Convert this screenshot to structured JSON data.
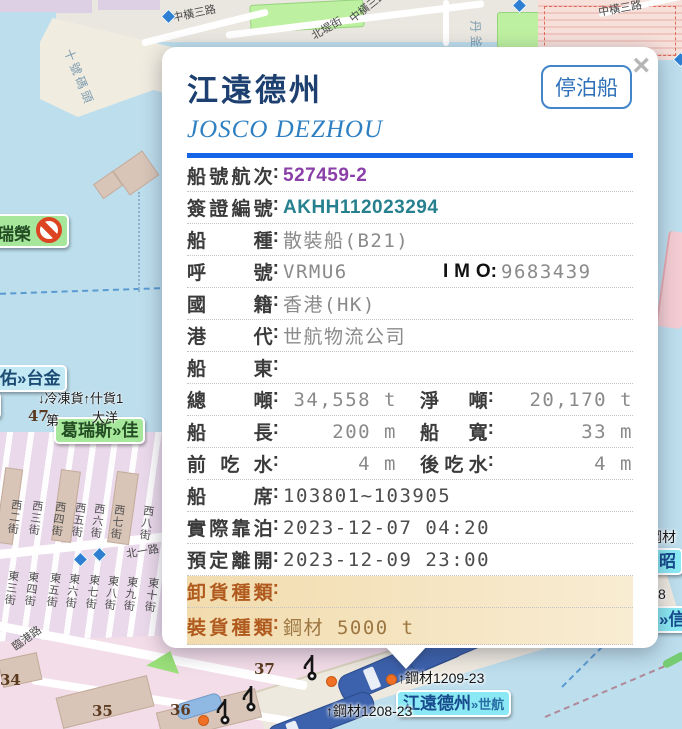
{
  "popup": {
    "title": "江遠德州",
    "subtitle": "JOSCO DEZHOU",
    "moor_button": "停泊船",
    "close": "×",
    "rows": [
      {
        "l1": "船號航次",
        "v1": "527459-2",
        "cls": "voyage"
      },
      {
        "l1": "簽證編號",
        "v1": "AKHH112023294",
        "cls": "visa"
      },
      {
        "l1": "船種",
        "v1": "散裝船(B21)",
        "cls": "plain"
      },
      {
        "l1": "呼號",
        "v1": "VRMU6",
        "l2": "I M O",
        "v2": "9683439",
        "cls": "callsign"
      },
      {
        "l1": "國籍",
        "v1": "香港(HK)",
        "cls": "plain"
      },
      {
        "l1": "港代",
        "v1": "世航物流公司",
        "cls": "plain"
      },
      {
        "l1": "船東",
        "v1": "",
        "cls": "plain"
      },
      {
        "l1": "總噸",
        "v1": "34,558 t",
        "l2": "淨噸",
        "v2": "20,170 t",
        "cls": "nums"
      },
      {
        "l1": "船長",
        "v1": "200 m",
        "l2": "船寬",
        "v2": "33 m",
        "cls": "nums"
      },
      {
        "l1": "前吃水",
        "v1": "4 m",
        "l2": "後吃水",
        "v2": "4 m",
        "cls": "nums"
      },
      {
        "l1": "船席",
        "v1": "103801~103905",
        "cls": "dark"
      },
      {
        "l1": "實際靠泊",
        "v1": "2023-12-07 04:20",
        "cls": "dark"
      },
      {
        "l1": "預定離開",
        "v1": "2023-12-09 23:00",
        "cls": "dark"
      },
      {
        "l1": "卸貨種類",
        "v1": "",
        "cls": "cargo"
      },
      {
        "l1": "裝貨種類",
        "v1": "鋼材 5000 t",
        "cls": "cargo"
      }
    ]
  },
  "map": {
    "road_labels": [
      {
        "t": "中橫三路",
        "x": 172,
        "y": 5,
        "r": -12
      },
      {
        "t": "中橫三路",
        "x": 346,
        "y": -2,
        "r": -38
      },
      {
        "t": "中橫三路",
        "x": 598,
        "y": 0,
        "r": -10
      },
      {
        "t": "北堤街",
        "x": 310,
        "y": 20,
        "r": -30
      },
      {
        "t": "北一路",
        "x": 126,
        "y": 543,
        "r": -10
      },
      {
        "t": "臨港路",
        "x": 10,
        "y": 630,
        "r": -36
      }
    ],
    "vertical_labels": [
      {
        "t": "十號碼頭",
        "x": 76,
        "y": 46,
        "r": 68
      },
      {
        "t": "丹釜川",
        "x": 484,
        "y": 20,
        "r": 88
      }
    ],
    "streets": [
      {
        "t": "西二街",
        "x": 6,
        "y": 499
      },
      {
        "t": "西三街",
        "x": 27,
        "y": 500
      },
      {
        "t": "西四街",
        "x": 50,
        "y": 501
      },
      {
        "t": "西五街",
        "x": 70,
        "y": 502
      },
      {
        "t": "西六街",
        "x": 89,
        "y": 503
      },
      {
        "t": "西七街",
        "x": 109,
        "y": 504
      },
      {
        "t": "西八街",
        "x": 138,
        "y": 505
      },
      {
        "t": "東三街",
        "x": 3,
        "y": 570
      },
      {
        "t": "東四街",
        "x": 23,
        "y": 571
      },
      {
        "t": "東五街",
        "x": 45,
        "y": 572
      },
      {
        "t": "東六街",
        "x": 64,
        "y": 573
      },
      {
        "t": "東七街",
        "x": 84,
        "y": 574
      },
      {
        "t": "東八街",
        "x": 103,
        "y": 575
      },
      {
        "t": "東九街",
        "x": 122,
        "y": 576
      },
      {
        "t": "東十街",
        "x": 143,
        "y": 577
      }
    ],
    "badges": [
      {
        "t": "瑞榮",
        "x": -10,
        "y": 214,
        "type": "green",
        "icon": "no-entry"
      },
      {
        "t": "大佑»台金",
        "x": -24,
        "y": 365,
        "type": "blue"
      },
      {
        "t": "台",
        "x": -30,
        "y": 392,
        "type": "blue"
      },
      {
        "t": "葛瑞斯»佳",
        "x": 54,
        "y": 417,
        "type": "green"
      },
      {
        "t": "江遠德州",
        "suffix": "»世航",
        "x": 396,
        "y": 690,
        "type": "cyan"
      },
      {
        "t": "昭",
        "x": 652,
        "y": 548,
        "type": "cyan"
      },
      {
        "t": "»信",
        "x": 652,
        "y": 606,
        "type": "cyan"
      }
    ],
    "cargo_labels": [
      {
        "t": "↑鋼材1209-23",
        "x": 398,
        "y": 668
      },
      {
        "t": "↑鋼材1208-23",
        "x": 326,
        "y": 701
      },
      {
        "t": "鋼材",
        "x": 648,
        "y": 527
      },
      {
        "t": "8",
        "x": 658,
        "y": 586
      }
    ],
    "berth_numbers": [
      {
        "t": "34",
        "x": 0,
        "y": 671
      },
      {
        "t": "35",
        "x": 92,
        "y": 702
      },
      {
        "t": "36",
        "x": 170,
        "y": 701
      },
      {
        "t": "37",
        "x": 254,
        "y": 660
      },
      {
        "t": "47",
        "x": 28,
        "y": 407
      }
    ],
    "small_texts": [
      {
        "t": "↓冷凍貨↑什貨1",
        "x": 38,
        "y": 388
      },
      {
        "t": "第",
        "x": 46,
        "y": 410
      },
      {
        "t": "大洋",
        "x": 92,
        "y": 407
      }
    ],
    "markers": {
      "diamonds": [
        {
          "x": 163,
          "y": 11
        },
        {
          "x": 514,
          "y": 0
        },
        {
          "x": 675,
          "y": 54
        },
        {
          "x": 75,
          "y": 554
        },
        {
          "x": 94,
          "y": 549
        }
      ],
      "dots": [
        {
          "x": 326,
          "y": 676
        },
        {
          "x": 386,
          "y": 674
        },
        {
          "x": 198,
          "y": 715
        }
      ]
    }
  }
}
